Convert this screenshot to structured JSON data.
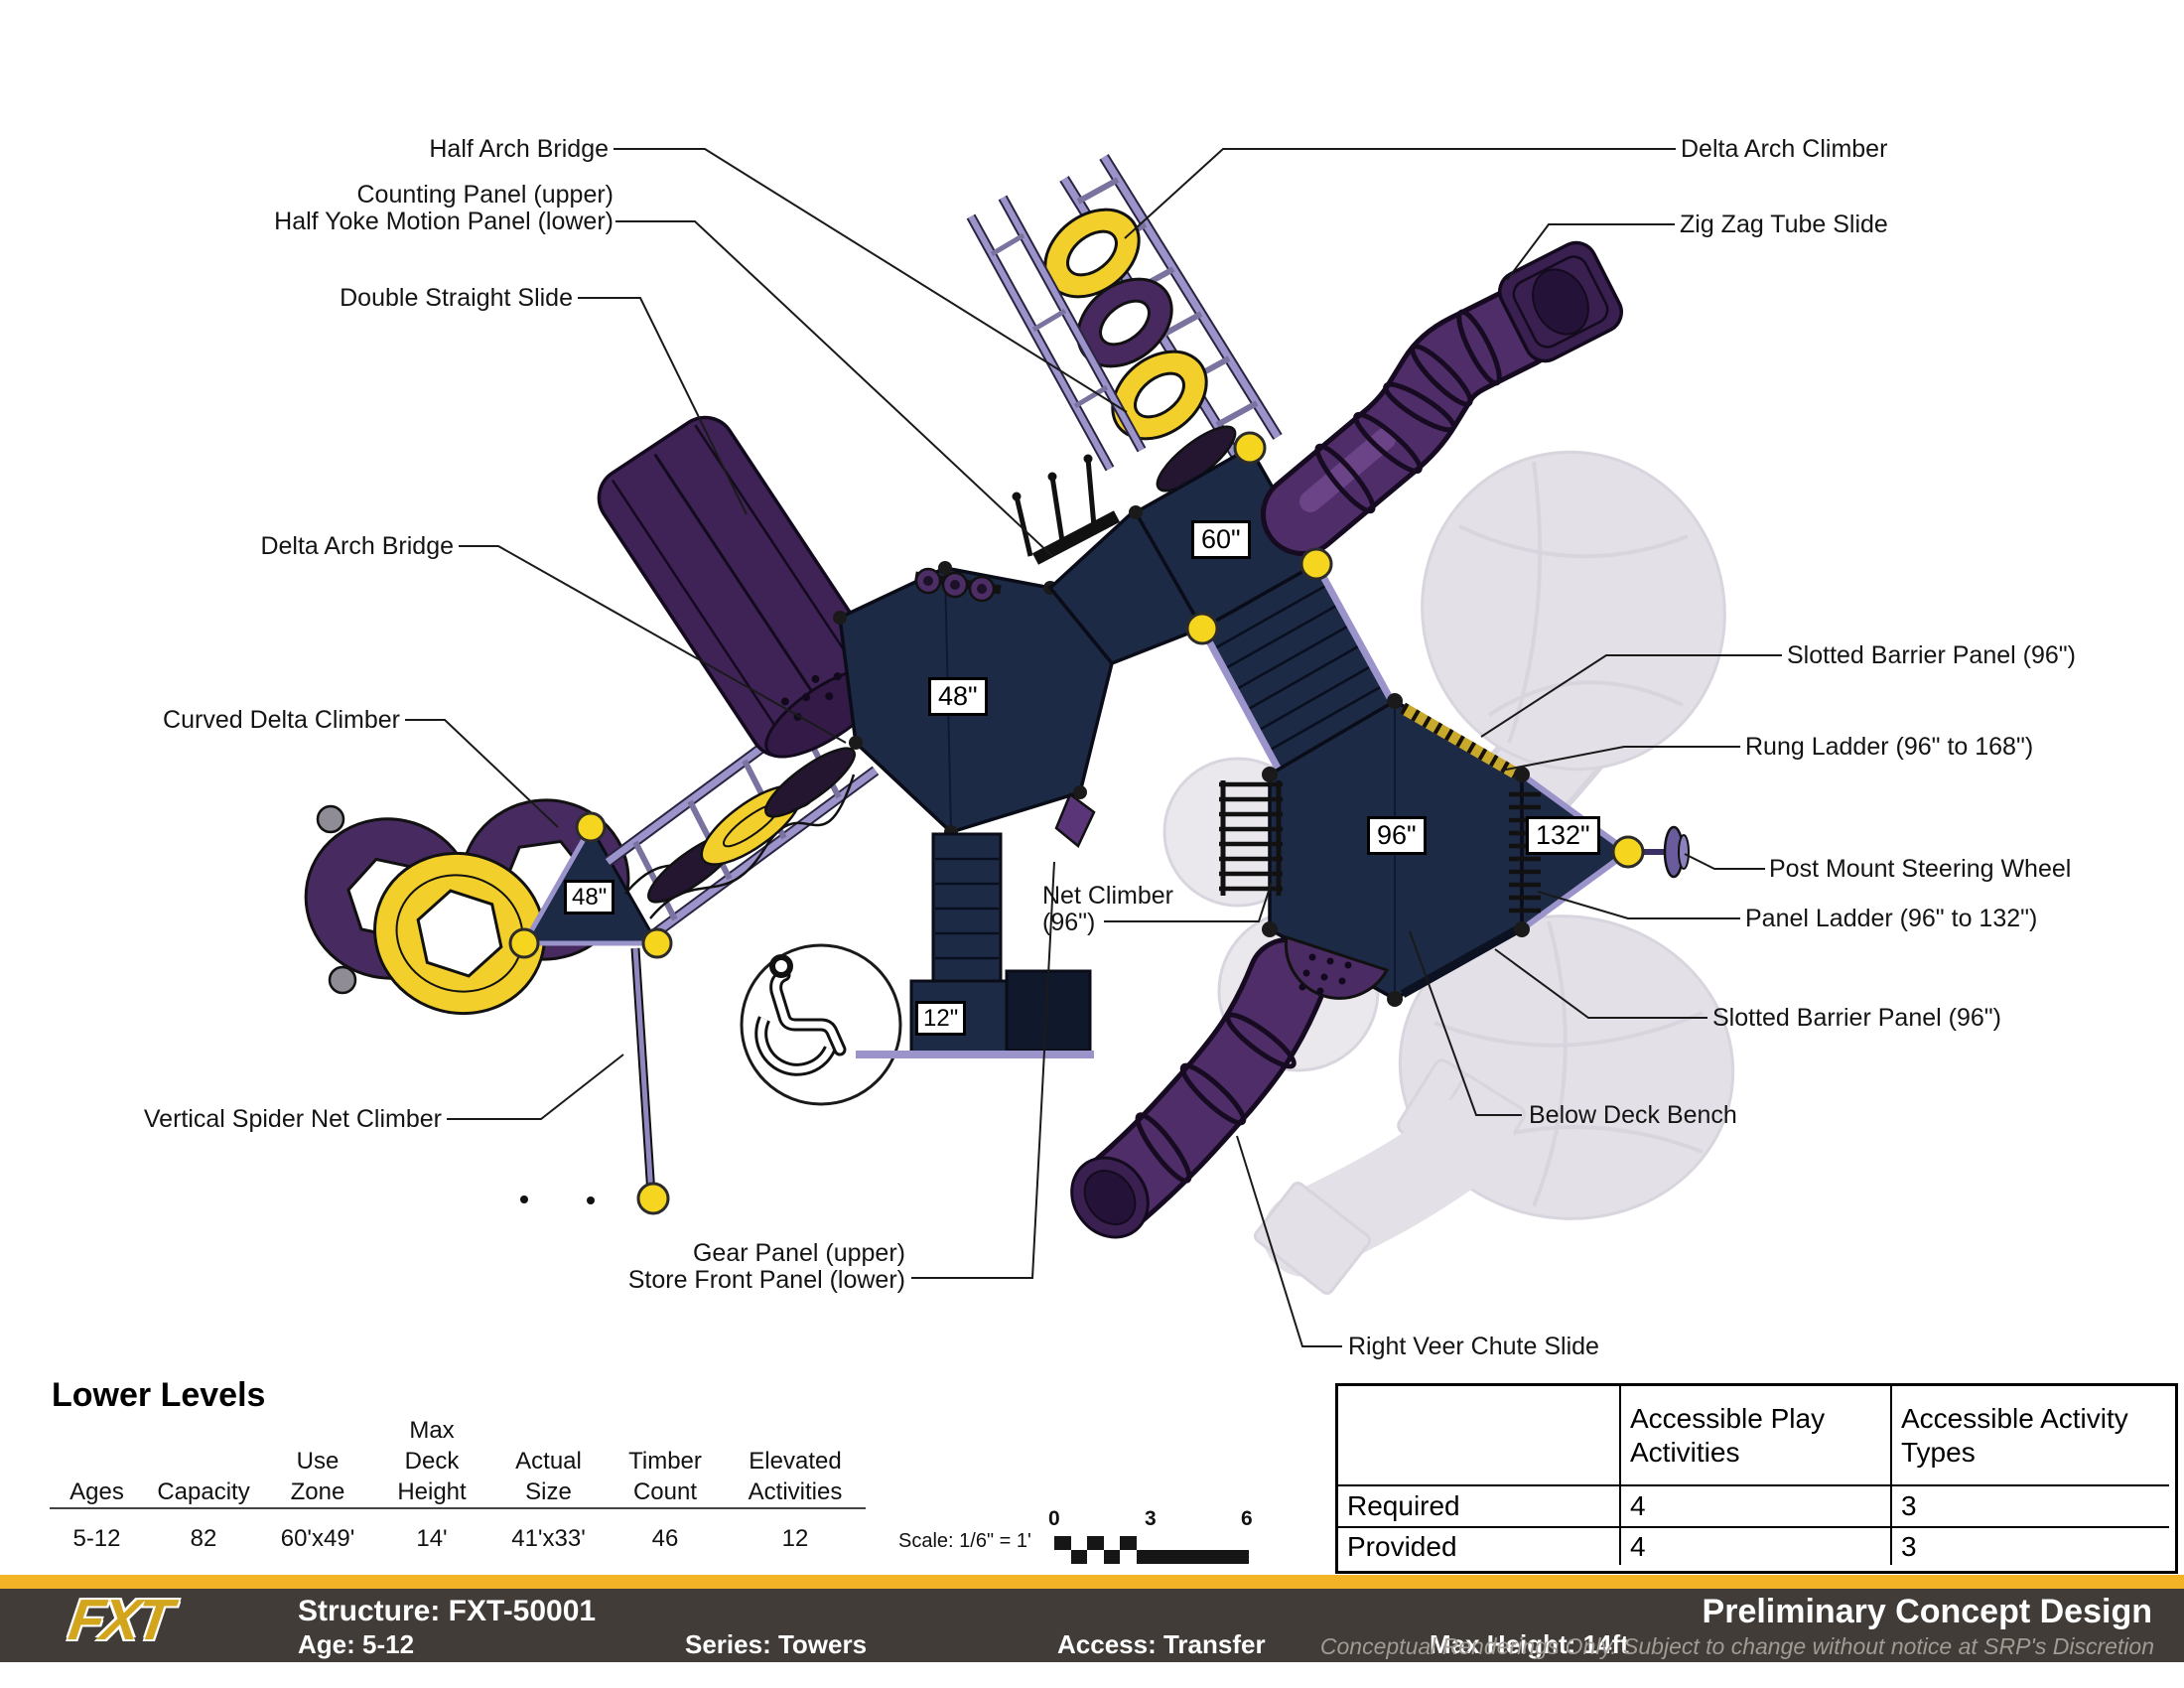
{
  "callouts": {
    "half_arch_bridge": "Half Arch Bridge",
    "counting_panel_line1": "Counting Panel (upper)",
    "counting_panel_line2": "Half Yoke Motion Panel (lower)",
    "double_straight_slide": "Double Straight Slide",
    "delta_arch_bridge": "Delta Arch Bridge",
    "curved_delta_climber": "Curved Delta Climber",
    "vertical_spider_net_climber": "Vertical Spider Net Climber",
    "gear_panel_line1": "Gear Panel (upper)",
    "gear_panel_line2": "Store Front Panel (lower)",
    "net_climber_line1": "Net Climber",
    "net_climber_line2": "(96\")",
    "delta_arch_climber": "Delta Arch Climber",
    "zig_zag_tube_slide": "Zig Zag Tube Slide",
    "slotted_barrier_panel_upper": "Slotted Barrier Panel (96\")",
    "rung_ladder": "Rung Ladder (96\" to 168\")",
    "post_mount_steering_wheel": "Post Mount Steering Wheel",
    "panel_ladder": "Panel Ladder (96\" to 132\")",
    "slotted_barrier_panel_lower": "Slotted Barrier Panel (96\")",
    "below_deck_bench": "Below Deck Bench",
    "right_veer_chute_slide": "Right Veer Chute Slide"
  },
  "deck_labels": {
    "d60": "60\"",
    "d48_main": "48\"",
    "d48_left": "48\"",
    "d96": "96\"",
    "d132": "132\"",
    "d12": "12\""
  },
  "lower_levels": {
    "title": "Lower Levels",
    "columns": [
      {
        "h": [
          "Ages"
        ],
        "v": "5-12"
      },
      {
        "h": [
          "Capacity"
        ],
        "v": "82"
      },
      {
        "h": [
          "Use",
          "Zone"
        ],
        "v": "60'x49'"
      },
      {
        "h": [
          "Max",
          "Deck",
          "Height"
        ],
        "v": "14'"
      },
      {
        "h": [
          "Actual",
          "Size"
        ],
        "v": "41'x33'"
      },
      {
        "h": [
          "Timber",
          "Count"
        ],
        "v": "46"
      },
      {
        "h": [
          "Elevated",
          "Activities"
        ],
        "v": "12"
      }
    ]
  },
  "scale": {
    "label": "Scale: 1/6\" = 1'",
    "ticks": [
      "0",
      "3",
      "6"
    ]
  },
  "accessibility_table": {
    "headers": [
      "",
      "Accessible Play Activities",
      "Accessible Activity Types"
    ],
    "rows": [
      {
        "label": "Required",
        "play": "4",
        "types": "3"
      },
      {
        "label": "Provided",
        "play": "4",
        "types": "3"
      }
    ]
  },
  "footer": {
    "logo": "FXT",
    "structure": "Structure: FXT-50001",
    "age": "Age: 5-12",
    "series": "Series: Towers",
    "access": "Access: Transfer",
    "max_height": "Max Height: 14ft",
    "title": "Preliminary Concept Design",
    "disclaimer": "Conceptual Renderings Only. Subject to change without notice at SRP's Discretion"
  },
  "colors": {
    "deck_navy": "#1c2a46",
    "slide_purple": "#4f2d68",
    "rail_purple": "#9a94ca",
    "accent_yellow": "#f2cf2a",
    "connector_yellow": "#f6d51f",
    "footer_yellow": "#f2b426",
    "footer_dark": "#413c38",
    "ghost_gray": "#c8c2d0"
  }
}
